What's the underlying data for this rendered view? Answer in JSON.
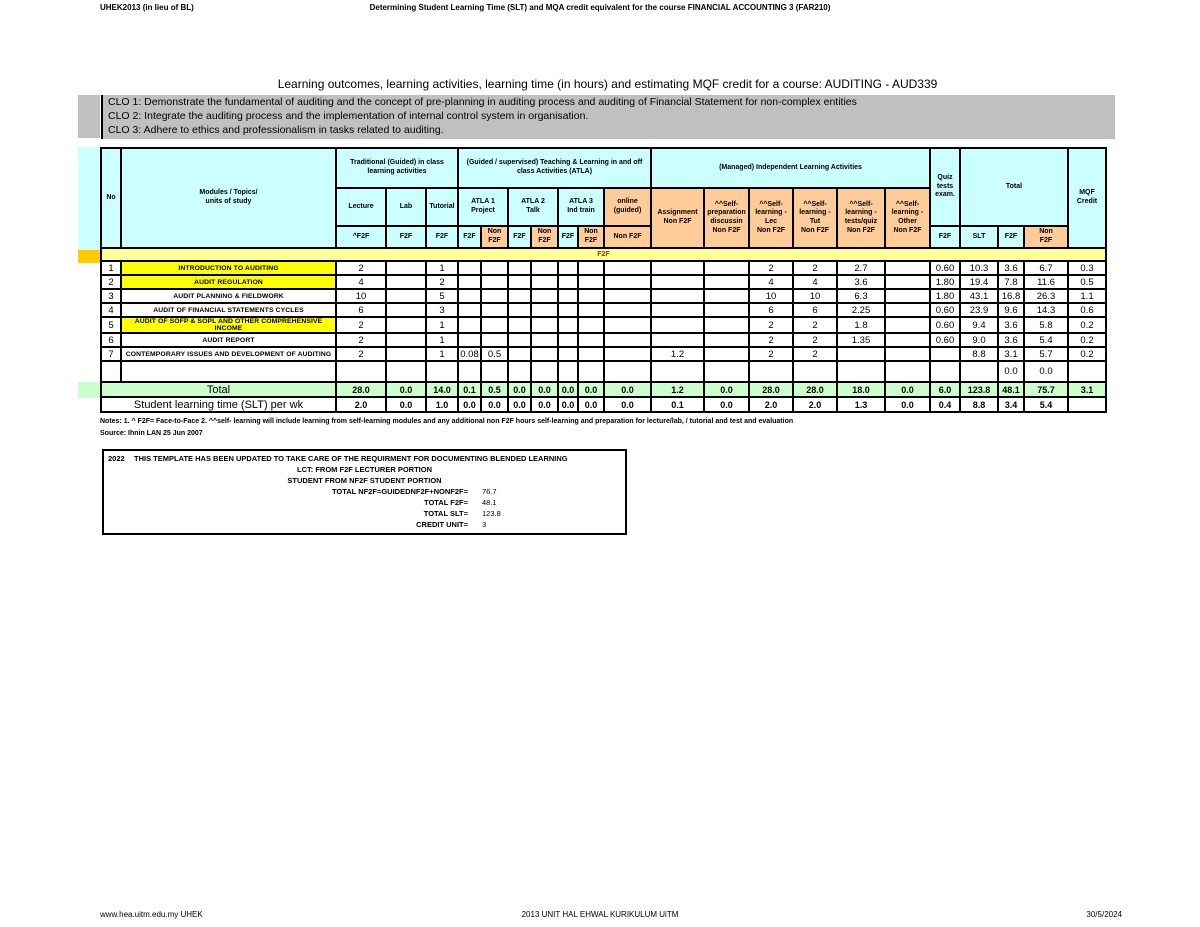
{
  "page_header": {
    "left": "UHEK2013 (in lieu of BL)",
    "center": "Determining Student Learning Time (SLT) and MQA credit equivalent for the course  FINANCIAL ACCOUNTING 3 (FAR210)"
  },
  "title": "Learning outcomes, learning activities, learning time (in hours)  and estimating MQF credit for a course: AUDITING - AUD339",
  "clo_lines": [
    "CLO 1: Demonstrate the fundamental of auditing and the concept of pre-planning in auditing process and auditing of Financial Statement for non-complex entities",
    "CLO 2: Integrate the auditing process and the implementation of internal control system in organisation.",
    "CLO 3: Adhere to ethics and professionalism in tasks related to auditing."
  ],
  "colors": {
    "header_cyan": "#CCFFFF",
    "non_f2f_orange": "#FFCC99",
    "section_band_yellow": "#FFFF99",
    "topic_highlight_yellow": "#FFFF00",
    "total_row_green": "#CCFFCC",
    "clo_gray": "#C0C0C0"
  },
  "table": {
    "header": {
      "no": "No",
      "modules": "Modules / Topics/\nunits of study",
      "band_traditional": "Traditional (Guided) in class\nlearning activities",
      "band_atla": "(Guided / supervised) Teaching & Learning in and off class Activities (ATLA)",
      "band_managed": "(Managed) Independent Learning Activities",
      "quiz": "Quiz\ntests\nexam.",
      "total": "Total",
      "mqf": "MQF\nCredit",
      "lecture": "Lecture",
      "lab": "Lab",
      "tutorial": "Tutorial",
      "atla1": "ATLA 1\nProject",
      "atla2": "ATLA 2\nTalk",
      "atla3": "ATLA 3\nInd train",
      "online": "online\n(guided)",
      "assignment": "Assignment\nNon F2F",
      "self_prep": "^^Self-preparation discussin\nNon F2F",
      "self_lec": "^^Self-learning - Lec\nNon F2F",
      "self_tut": "^^Self-learning - Tut\nNon F2F",
      "self_quiz": "^^Self-learning - tests/quiz\nNon F2F",
      "self_other": "^^Self-learning - Other\nNon  F2F",
      "f2f_caret": "^F2F",
      "f2f": "F2F",
      "non_f2f_2line": "Non\nF2F",
      "non_f2f_1line": "Non F2F",
      "slt": "SLT"
    },
    "section_label": "F2F",
    "rows": [
      {
        "no": "1",
        "topic": "INTRODUCTION TO AUDITING",
        "highlight": true,
        "values": [
          "2",
          "",
          "1",
          "",
          "",
          "",
          "",
          "",
          "",
          "",
          "",
          "",
          "2",
          "2",
          "2.7",
          "",
          "0.60",
          "10.3",
          "3.6",
          "6.7",
          "0.3"
        ]
      },
      {
        "no": "2",
        "topic": "AUDIT REGULATION",
        "highlight": true,
        "values": [
          "4",
          "",
          "2",
          "",
          "",
          "",
          "",
          "",
          "",
          "",
          "",
          "",
          "4",
          "4",
          "3.6",
          "",
          "1.80",
          "19.4",
          "7.8",
          "11.6",
          "0.5"
        ]
      },
      {
        "no": "3",
        "topic": "AUDIT PLANNING & FIELDWORK",
        "highlight": false,
        "values": [
          "10",
          "",
          "5",
          "",
          "",
          "",
          "",
          "",
          "",
          "",
          "",
          "",
          "10",
          "10",
          "6.3",
          "",
          "1.80",
          "43.1",
          "16.8",
          "26.3",
          "1.1"
        ]
      },
      {
        "no": "4",
        "topic": "AUDIT OF FINANCIAL STATEMENTS CYCLES",
        "highlight": false,
        "values": [
          "6",
          "",
          "3",
          "",
          "",
          "",
          "",
          "",
          "",
          "",
          "",
          "",
          "6",
          "6",
          "2.25",
          "",
          "0.60",
          "23.9",
          "9.6",
          "14.3",
          "0.6"
        ]
      },
      {
        "no": "5",
        "topic": "AUDIT OF SOFP & SOPL AND OTHER COMPREHENSIVE INCOME",
        "highlight": true,
        "values": [
          "2",
          "",
          "1",
          "",
          "",
          "",
          "",
          "",
          "",
          "",
          "",
          "",
          "2",
          "2",
          "1.8",
          "",
          "0.60",
          "9.4",
          "3.6",
          "5.8",
          "0.2"
        ]
      },
      {
        "no": "6",
        "topic": "AUDIT REPORT",
        "highlight": false,
        "values": [
          "2",
          "",
          "1",
          "",
          "",
          "",
          "",
          "",
          "",
          "",
          "",
          "",
          "2",
          "2",
          "1.35",
          "",
          "0.60",
          "9.0",
          "3.6",
          "5.4",
          "0.2"
        ]
      },
      {
        "no": "7",
        "topic": "CONTEMPORARY ISSUES AND DEVELOPMENT OF AUDITING",
        "highlight": false,
        "values": [
          "2",
          "",
          "1",
          "0.08",
          "0.5",
          "",
          "",
          "",
          "",
          "",
          "1.2",
          "",
          "2",
          "2",
          "",
          "",
          "",
          "8.8",
          "3.1",
          "5.7",
          "0.2"
        ]
      }
    ],
    "empty_row_values": [
      "",
      "",
      "",
      "",
      "",
      "",
      "",
      "",
      "",
      "",
      "",
      "",
      "",
      "",
      "",
      "",
      "",
      "",
      "0.0",
      "0.0",
      ""
    ],
    "total_row": {
      "label": "Total",
      "values": [
        "28.0",
        "0.0",
        "14.0",
        "0.1",
        "0.5",
        "0.0",
        "0.0",
        "0.0",
        "0.0",
        "0.0",
        "1.2",
        "0.0",
        "28.0",
        "28.0",
        "18.0",
        "0.0",
        "6.0",
        "123.8",
        "48.1",
        "75.7",
        "3.1"
      ]
    },
    "slt_row": {
      "label": "Student learning time (SLT) per wk",
      "values": [
        "2.0",
        "0.0",
        "1.0",
        "0.0",
        "0.0",
        "0.0",
        "0.0",
        "0.0",
        "0.0",
        "0.0",
        "0.1",
        "0.0",
        "2.0",
        "2.0",
        "1.3",
        "0.0",
        "0.4",
        "8.8",
        "3.4",
        "5.4",
        ""
      ]
    }
  },
  "notes_line1": "Notes:  1. ^ F2F= Face-to-Face  2. ^^self- learning will include learning from self-learning modules and any  additional non F2F hours self-learning and preparation for lecture/lab, / tutorial and test and evaluation",
  "source_line": "Source: Ihnin LAN 25 Jun 2007",
  "update_box": {
    "year": "2022",
    "line1": "THIS TEMPLATE HAS BEEN UPDATED TO TAKE CARE OF THE REQUIRMENT FOR DOCUMENTING BLENDED LEARNING",
    "line2": "LCT:  FROM F2F LECTURER PORTION",
    "line3": "STUDENT  FROM NF2F STUDENT PORTION",
    "calc_rows": [
      {
        "label": "TOTAL NF2F=GUIDEDNF2F+NONF2F=",
        "value": "76.7"
      },
      {
        "label": "TOTAL F2F=",
        "value": "48.1"
      },
      {
        "label": "TOTAL SLT=",
        "value": "123.8"
      },
      {
        "label": "CREDIT UNIT=",
        "value": "3"
      }
    ]
  },
  "footer": {
    "left": "www.hea.uitm.edu.my UHEK",
    "center": "2013 UNIT HAL EHWAL KURIKULUM UiTM",
    "right": "30/5/2024"
  }
}
